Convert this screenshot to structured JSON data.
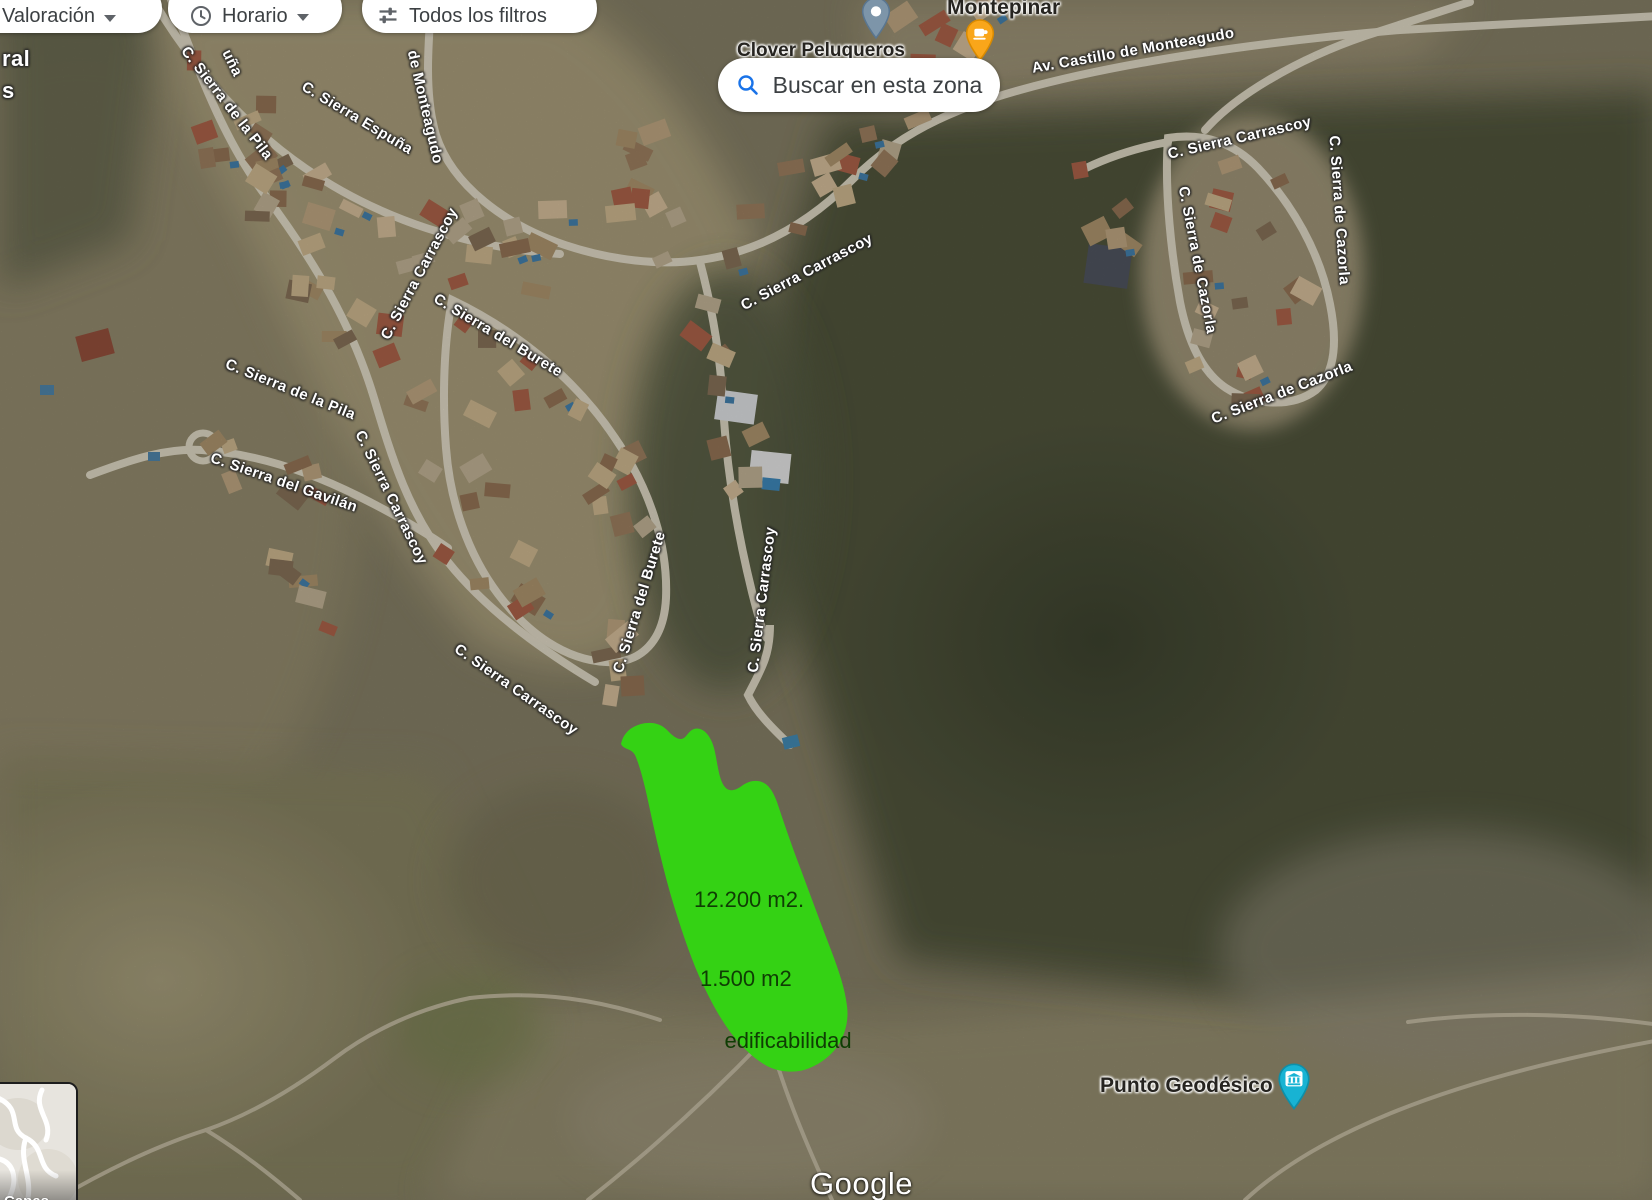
{
  "map": {
    "attribution": "Google",
    "filters": [
      {
        "id": "valoracion",
        "label": "Valoración",
        "icon": null,
        "has_dropdown": true
      },
      {
        "id": "horario",
        "label": "Horario",
        "icon": "clock-icon",
        "has_dropdown": true
      },
      {
        "id": "todos-los-filtros",
        "label": "Todos los filtros",
        "icon": "tune-icon",
        "has_dropdown": false
      }
    ],
    "search_button": {
      "label": "Buscar en esta zona",
      "icon": "search-icon",
      "icon_color": "#1a73e8"
    },
    "layers_control": {
      "label": "Capas"
    },
    "poi_labels": {
      "montepinar": {
        "text": "Montepinar"
      },
      "clover": {
        "text": "Clover Peluqueros"
      },
      "geodesico": {
        "text": "Punto Geodésico"
      }
    },
    "markers": [
      {
        "name": "place-pin",
        "color": "#7d95a9"
      },
      {
        "name": "cafe-pin",
        "color": "#f9a61a"
      },
      {
        "name": "geodesic-pin",
        "color": "#18b3d3"
      }
    ],
    "parcel_overlay": {
      "fill": "#34d214",
      "area_text": "12.200 m2.",
      "build_text_1": "1.500 m2",
      "build_text_2": "edificabilidad"
    },
    "street_labels": [
      {
        "text": "C. Sierra de la Pila",
        "x": 184,
        "y": 40,
        "rot": 52
      },
      {
        "text": "uña",
        "x": 226,
        "y": 42,
        "rot": 64
      },
      {
        "text": "C. Sierra Espuña",
        "x": 303,
        "y": 77,
        "rot": 31
      },
      {
        "text": "de Monteagudo",
        "x": 412,
        "y": 42,
        "rot": 77
      },
      {
        "text": "C. Sierra Carrascoy",
        "x": 385,
        "y": 330,
        "rot": -62
      },
      {
        "text": "C. Sierra del Burete",
        "x": 435,
        "y": 289,
        "rot": 31
      },
      {
        "text": "C. Sierra de la Pila",
        "x": 226,
        "y": 355,
        "rot": 22
      },
      {
        "text": "C. Sierra del Gavilán",
        "x": 211,
        "y": 449,
        "rot": 19
      },
      {
        "text": "C. Sierra Carrascoy",
        "x": 359,
        "y": 423,
        "rot": 64
      },
      {
        "text": "C. Sierra Carrascoy",
        "x": 456,
        "y": 639,
        "rot": 35
      },
      {
        "text": "C. Sierra del Burete",
        "x": 618,
        "y": 664,
        "rot": -73
      },
      {
        "text": "C. Sierra Carrascoy",
        "x": 753,
        "y": 664,
        "rot": -83
      },
      {
        "text": "C. Sierra Carrascoy",
        "x": 742,
        "y": 298,
        "rot": -28
      },
      {
        "text": "Av. Castillo de Monteagudo",
        "x": 1032,
        "y": 60,
        "rot": -10
      },
      {
        "text": "C. Sierra Carrascoy",
        "x": 1168,
        "y": 146,
        "rot": -13
      },
      {
        "text": "C. Sierra de Cazorla",
        "x": 1183,
        "y": 178,
        "rot": 79
      },
      {
        "text": "C. Sierra de Cazorla",
        "x": 1334,
        "y": 127,
        "rot": 86
      },
      {
        "text": "C. Sierra de Cazorla",
        "x": 1212,
        "y": 411,
        "rot": -21
      },
      {
        "text": "ral",
        "x": 2,
        "y": 46,
        "rot": 0,
        "size": 22
      },
      {
        "text": "s",
        "x": 2,
        "y": 78,
        "rot": 0,
        "size": 22
      }
    ]
  }
}
